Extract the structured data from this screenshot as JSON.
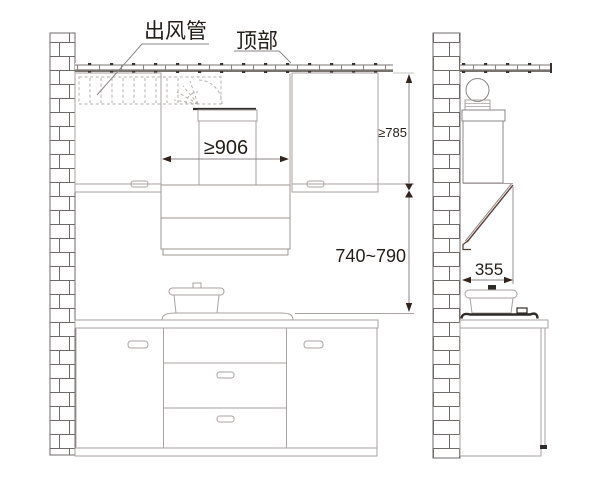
{
  "figure": {
    "callouts": {
      "duct_label": "出风管",
      "ceiling_label": "顶部"
    },
    "dimensions": {
      "hood_min_width": "≥906",
      "ceiling_to_cabinet_min": "≥785",
      "cooktop_to_hood_range": "740~790",
      "hood_depth": "355"
    },
    "colors": {
      "ink": "#2b2522",
      "line_light": "#a9a2a0",
      "line_medium": "#6e6a68",
      "dimension_line": "#8a8684",
      "arrow": "#33231d",
      "accent_dark": "#2e2a28",
      "hood_glass_brown": "#5a4038"
    }
  }
}
